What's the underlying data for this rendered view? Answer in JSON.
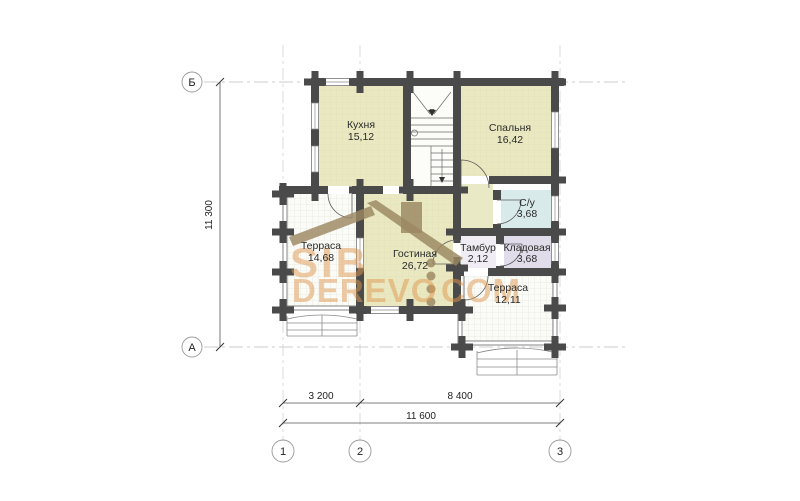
{
  "rooms": [
    {
      "name": "Кухня",
      "area": "15,12"
    },
    {
      "name": "Спальня",
      "area": "16,42"
    },
    {
      "name": "Терраса",
      "area": "14,68"
    },
    {
      "name": "Гостиная",
      "area": "26,72"
    },
    {
      "name": "С/у",
      "area": "3,68"
    },
    {
      "name": "Тамбур",
      "area": "2,12"
    },
    {
      "name": "Кладовая",
      "area": "3,68"
    },
    {
      "name": "Терраса",
      "area": "12,11"
    }
  ],
  "axes": {
    "left": [
      "Б",
      "А"
    ],
    "bottom": [
      "1",
      "2",
      "3"
    ]
  },
  "dimensions": {
    "height": "11 300",
    "bottom_segment_1": "3 200",
    "bottom_segment_2": "8 400",
    "bottom_total": "11 600"
  },
  "watermark": {
    "line1": "SIB",
    "line2_word": "DEREVO",
    "line2_tld": "COM"
  },
  "colors": {
    "wall": "#4a4a4a",
    "room_yellow": "#e9e8c1",
    "room_blue": "#d8eaea",
    "room_lavender": "#e1dcea",
    "room_vestibule": "#efedf3",
    "hall": "#eae9c6",
    "terrace": "#fbfbf7",
    "watermark_orange": "#e0984f",
    "logo_brown": "#9b8862",
    "label_text": "#222222"
  }
}
